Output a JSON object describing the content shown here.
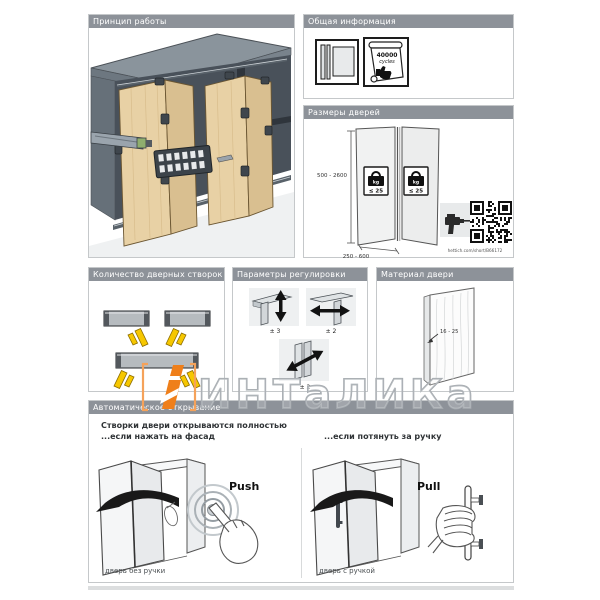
{
  "watermark": {
    "text": "ИНТаЛИКа"
  },
  "panels": {
    "principle": {
      "title": "Принцип работы"
    },
    "general_info": {
      "title": "Общая информация",
      "certificate": {
        "line1": "40000",
        "line2": "cycles"
      }
    },
    "door_sizes": {
      "title": "Размеры дверей",
      "height_range": "500 - 2600",
      "width_range": "250 - 600",
      "weight_badge": {
        "unit": "kg",
        "limit": "≤ 25"
      },
      "link": "hettich.com/short/B66172"
    },
    "leaf_count": {
      "title": "Количество дверных створок"
    },
    "adjustment": {
      "title": "Параметры регулировки",
      "vertical_label": "± 3",
      "horizontal_label": "± 2",
      "diagonal_label": "± 2"
    },
    "material": {
      "title": "Материал двери",
      "thickness_range": "16 - 25"
    },
    "auto_opening": {
      "title": "Автоматическое открывание",
      "intro_line1": "Створки двери открываются полностью",
      "intro_line2_left": "...если нажать на фасад",
      "intro_line2_right": "...если потянуть за ручку",
      "push_label": "Push",
      "pull_label": "Pull",
      "caption_left": "дверь без ручки",
      "caption_right": "дверь с ручкой"
    }
  },
  "icons": {
    "catalog": "catalog-book-icon",
    "certificate": "cycles-certificate-icon",
    "thumb_up": "thumb-up-icon",
    "weight": "weight-kg-icon",
    "drill": "drill-icon",
    "qr": "qr-code",
    "push_hand": "push-hand-icon",
    "pull_hand": "pull-hand-icon"
  },
  "colors": {
    "header_bar": "#8d9299",
    "accent_orange": "#ef7f1a",
    "door_wood": "#e8d1a5",
    "arrow_yellow": "#f6c700",
    "cabinet_gray": "#8a949c"
  }
}
